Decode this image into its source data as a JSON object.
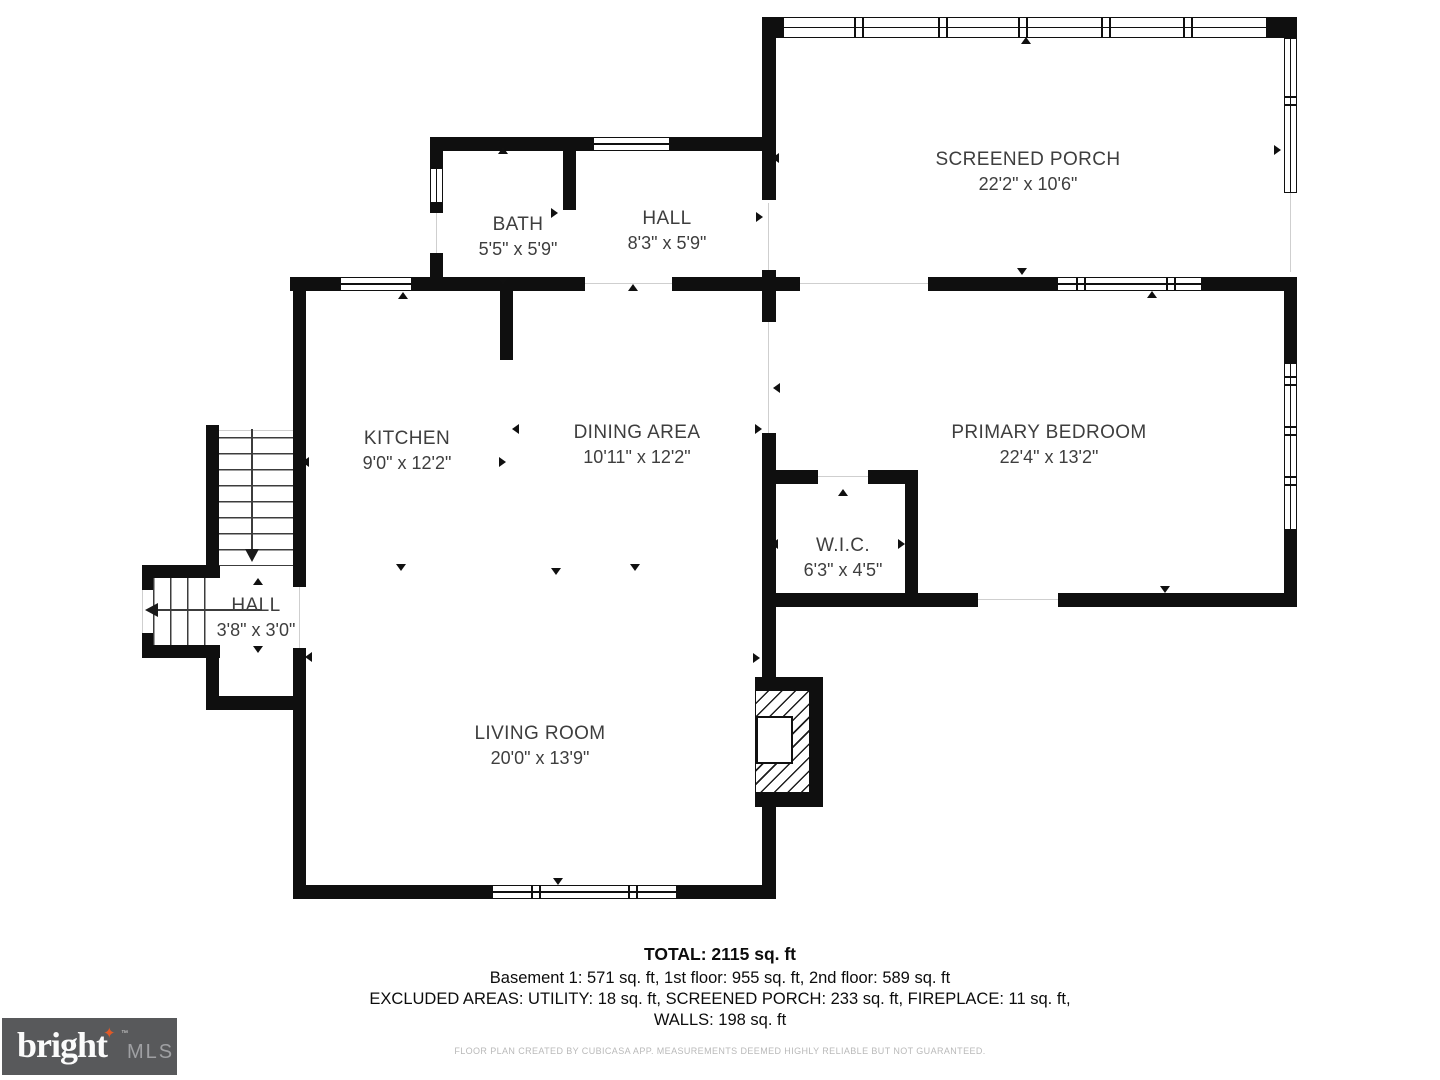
{
  "rooms": [
    {
      "id": "screened-porch",
      "name": "SCREENED PORCH",
      "dims": "22'2\" x 10'6\""
    },
    {
      "id": "bath",
      "name": "BATH",
      "dims": "5'5\" x 5'9\""
    },
    {
      "id": "hall-upper",
      "name": "HALL",
      "dims": "8'3\" x 5'9\""
    },
    {
      "id": "kitchen",
      "name": "KITCHEN",
      "dims": "9'0\" x 12'2\""
    },
    {
      "id": "dining-area",
      "name": "DINING AREA",
      "dims": "10'11\" x 12'2\""
    },
    {
      "id": "primary-bedroom",
      "name": "PRIMARY BEDROOM",
      "dims": "22'4\" x 13'2\""
    },
    {
      "id": "wic",
      "name": "W.I.C.",
      "dims": "6'3\" x 4'5\""
    },
    {
      "id": "hall-lower",
      "name": "HALL",
      "dims": "3'8\" x 3'0\""
    },
    {
      "id": "living-room",
      "name": "LIVING ROOM",
      "dims": "20'0\" x 13'9\""
    }
  ],
  "summary": {
    "total": "TOTAL: 2115 sq. ft",
    "floors": "Basement 1: 571 sq. ft, 1st floor: 955 sq. ft, 2nd floor: 589 sq. ft",
    "excluded": "EXCLUDED AREAS: UTILITY: 18 sq. ft, SCREENED PORCH: 233 sq. ft, FIREPLACE: 11 sq. ft,",
    "walls": "WALLS: 198 sq. ft"
  },
  "disclaimer": "FLOOR PLAN CREATED BY CUBICASA APP. MEASUREMENTS DEEMED HIGHLY RELIABLE BUT NOT GUARANTEED.",
  "logo": {
    "brand": "bright",
    "suffix": "MLS",
    "tm": "™",
    "star": "✦"
  },
  "colors": {
    "wall": "#0f0f0f",
    "accent": "#e05a28",
    "logo_bg": "#58595b",
    "label_text": "#3e3e3e",
    "disclaimer_text": "#b9b9b9"
  }
}
